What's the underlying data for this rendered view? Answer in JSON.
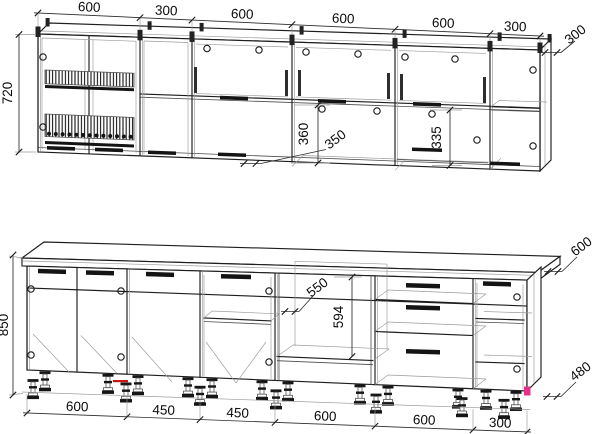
{
  "dims": {
    "upper_widths": [
      "600",
      "300",
      "600",
      "600",
      "600",
      "300"
    ],
    "upper_height": "720",
    "upper_depth": "300",
    "upper_niche_height": "360",
    "upper_niche_depth": "350",
    "upper_niche2_height": "335",
    "lower_widths": [
      "600",
      "450",
      "450",
      "600",
      "600",
      "300"
    ],
    "lower_height": "850",
    "counter_depth": "600",
    "base_depth": "480",
    "oven_niche_width": "550",
    "oven_niche_height": "594"
  }
}
